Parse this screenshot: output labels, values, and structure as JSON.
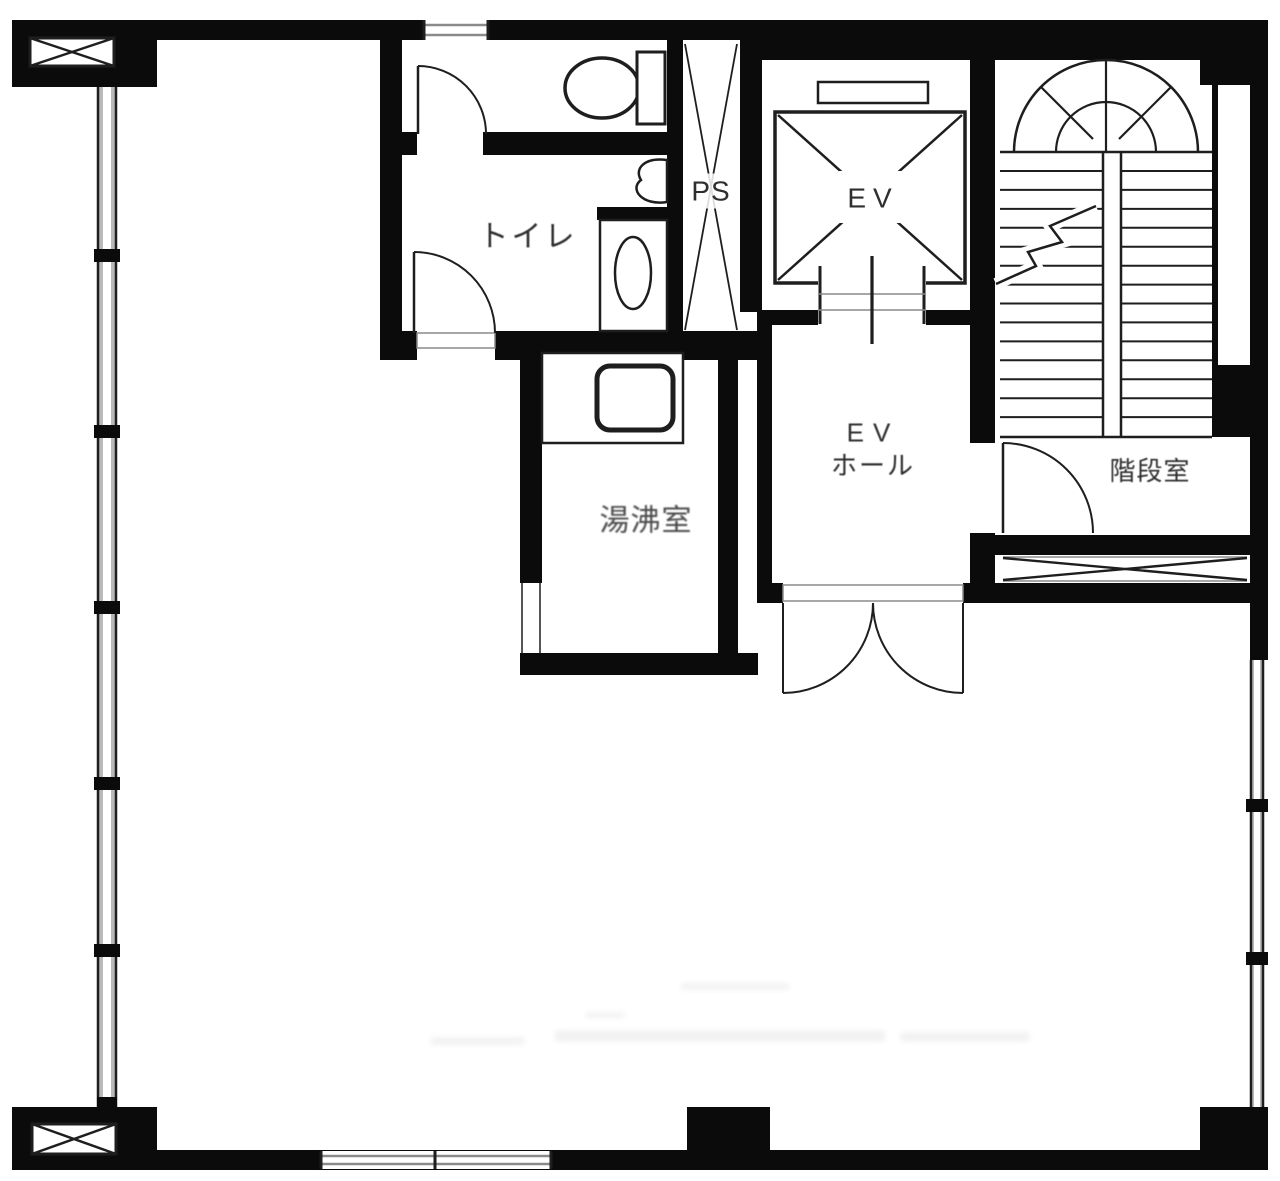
{
  "plan": {
    "type": "building-floor-plan",
    "rooms": {
      "toilet": {
        "label": "トイレ"
      },
      "pipe_space": {
        "label": "PS"
      },
      "elevator": {
        "label": "EV"
      },
      "elevator_hall": {
        "label": "EV",
        "label2": "ホール"
      },
      "kitchenette": {
        "label": "湯沸室"
      },
      "stairwell": {
        "label": "階段室"
      }
    },
    "colors": {
      "wall": "#0b0b0b",
      "line": "#1e1e1e",
      "soft": "#8a8a8a",
      "text": "#2e2e2e",
      "background": "#ffffff"
    }
  }
}
